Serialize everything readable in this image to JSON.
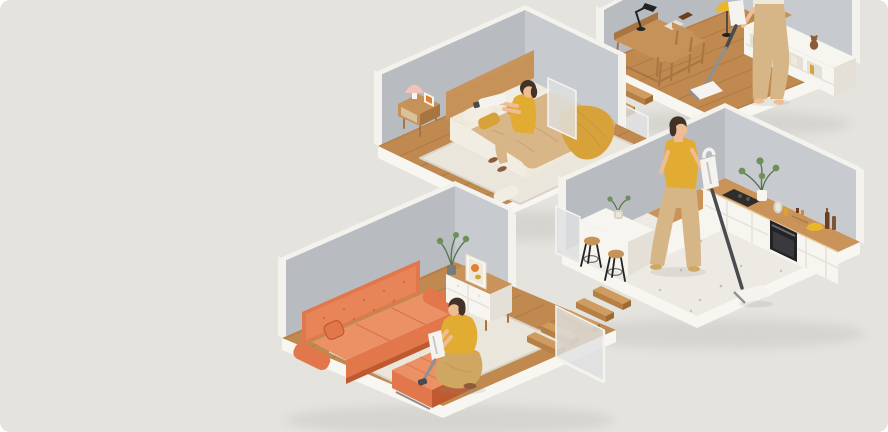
{
  "scene": {
    "description": "Isometric cutaway home with four floating room platforms connected by suspended wooden stairs and frosted glass panels; in every room a woman in a mustard top and beige trousers cleans with a cordless vacuum.",
    "visible_text": "none",
    "rooms": [
      {
        "id": "study",
        "label": "Study (top right, cropped by frame)",
        "floor": "oak plank wood",
        "objects": [
          "wooden desk with riser shelf",
          "black articulated desk lamp",
          "gray notebook",
          "wooden chair",
          "yellow dome floor lamp",
          "white shelf sideboard with open cubbies and books",
          "teddy bear",
          "storage box",
          "standing woman (legs visible, cream outfit)",
          "cordless stick vacuum"
        ]
      },
      {
        "id": "bedroom",
        "label": "Bedroom (upper middle left)",
        "floor": "oak plank wood",
        "objects": [
          "wood headboard double bed",
          "beige duvet and white sheets",
          "white and mustard pillows",
          "mustard throw blanket",
          "white area rug",
          "floor cushion",
          "wooden nightstand with rattan door",
          "pink table lamp",
          "photo frame",
          "brown slippers",
          "woman sitting on bed vacuuming pillows with handheld vacuum"
        ]
      },
      {
        "id": "kitchen",
        "label": "Kitchen (middle right)",
        "floor": "light terrazzo",
        "objects": [
          "white cabinet run with wooden countertop",
          "black cooktop",
          "black built-in oven",
          "potted green plant",
          "ceramic vases",
          "wooden spice crate",
          "bananas",
          "two brown bottles",
          "white island table",
          "two stools with wooden seats and black legs",
          "small plant on island",
          "woman pushing cordless stick vacuum"
        ]
      },
      {
        "id": "living-room",
        "label": "Living room (bottom left)",
        "floor": "oak plank wood",
        "objects": [
          "orange tufted three-seat sofa",
          "orange throw pillow",
          "orange ottoman",
          "cream shag rug",
          "white sideboard with wooden top and drawers",
          "leafy plant in vase",
          "leaning framed abstract art",
          "crouching woman cleaning ottoman with handheld vacuum"
        ]
      }
    ],
    "connectors": [
      {
        "id": "stairs-study-bedroom",
        "type": "floating wooden steps",
        "count": 4,
        "glass_panels": 2
      },
      {
        "id": "stairs-bedroom-kitchen",
        "type": "floating wooden steps",
        "count": 5,
        "glass_panels": 1
      },
      {
        "id": "stairs-kitchen-living",
        "type": "floating wooden steps",
        "count": 5,
        "glass_panels": 1
      }
    ],
    "people_count": 4,
    "vacuums": [
      "stick vacuum (study)",
      "handheld vacuum (bedroom)",
      "stick vacuum (kitchen)",
      "handheld vacuum (living room)"
    ]
  },
  "colors": {
    "bg": "#e4e3de",
    "wall": "#b8bcc1",
    "wallLight": "#c7cacE",
    "trim": "#f4f2ed",
    "plinth": "#f8f6f1",
    "wood": "#bf8950",
    "plank": "#8f5c2c",
    "terrazzo": "#eceae3",
    "speck": "#c6c2b8",
    "stairTop": "#cf9b5e",
    "stairFront": "#b67f44",
    "stairSide": "#9e6a33",
    "glass": "#dfe1e0",
    "glassEdge": "#f4f4f2",
    "sofa": "#e2774b",
    "sofaDark": "#bf5a30",
    "sofaLight": "#ec9165",
    "rug": "#eae6dc",
    "rugShade": "#d8d3c6",
    "duvet": "#d8b687",
    "sheet": "#efe9da",
    "pillow": "#f2ede2",
    "mustard": "#d8a23b",
    "skin": "#eebd94",
    "hair": "#423228",
    "topYellow": "#e2ab32",
    "pantsTan": "#d6b586",
    "pantsSatin": "#cfa763",
    "shoe": "#8d5b3a",
    "vacBody": "#f5f3ef",
    "vacGray": "#8e9094",
    "vacDark": "#4a4b4f",
    "cabinet": "#f7f5f0",
    "cabinetShade": "#e4e0d8",
    "counterWood": "#c9935a",
    "black": "#232325",
    "plantGreen": "#6f8f5a",
    "plantDark": "#55744a",
    "woodFurn": "#c79257",
    "woodFurnDark": "#a87440",
    "lampYellow": "#e9b62c",
    "lampPink": "#f2c3bb",
    "bottle": "#6e3f1d",
    "artOrange": "#e08030",
    "shadow": "#8f8b80"
  }
}
